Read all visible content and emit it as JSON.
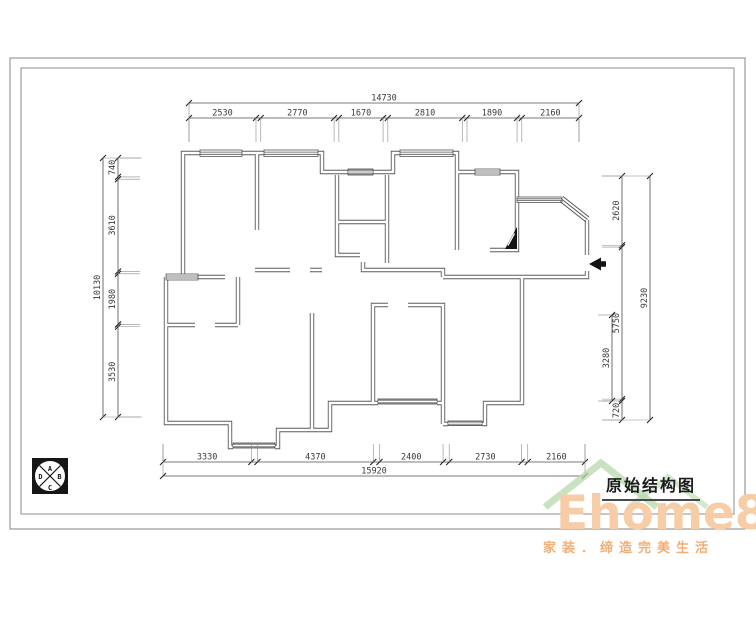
{
  "sheet": {
    "border_color": "#8f8f8f",
    "line_color": "#4f4f4f"
  },
  "title_block": {
    "title": "原始结构图"
  },
  "watermark": {
    "brand": "Ehome8",
    "tagline": "家装．缔造完美生活",
    "brand_color": "#f6cda6",
    "tagline_color": "#f4ad74",
    "roof_color": "#b7d8ab"
  },
  "elevation_symbol": {
    "top": "A",
    "right": "B",
    "bottom": "C",
    "left": "D"
  },
  "dimensions": {
    "top": {
      "overall": "14730",
      "segments": [
        "2530",
        "2770",
        "1670",
        "2810",
        "1890",
        "2160"
      ]
    },
    "bottom": {
      "overall": "15920",
      "segments": [
        "3330",
        "4370",
        "2400",
        "2730",
        "2160"
      ]
    },
    "left": {
      "overall": "10130",
      "segments": [
        "740",
        "3610",
        "1980",
        "3530"
      ]
    },
    "right": {
      "overall": "9230",
      "segments": [
        "2620",
        "5750",
        "720"
      ],
      "sub": "3280"
    }
  }
}
